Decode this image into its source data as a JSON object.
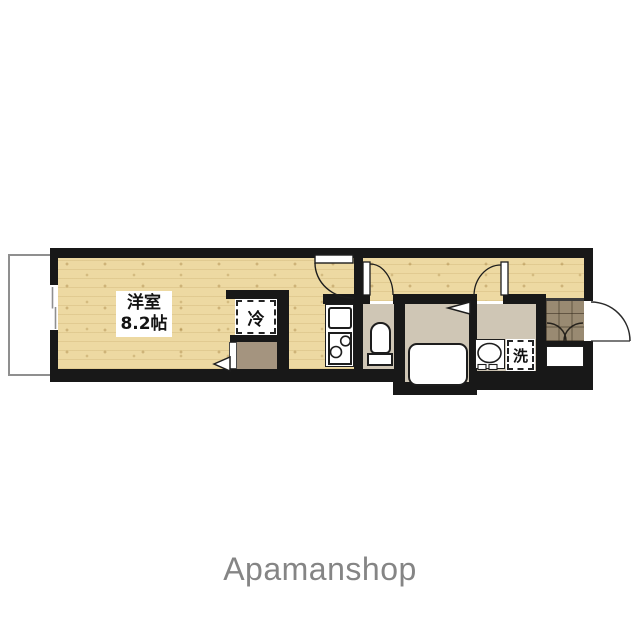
{
  "floorplan": {
    "room": {
      "name": "洋室",
      "size": "8.2帖"
    },
    "refrigerator_label": "冷",
    "laundry_label": "洗",
    "features": [
      "balcony",
      "main-room",
      "hallway",
      "kitchen",
      "toilet",
      "bathroom",
      "washroom",
      "entrance",
      "closet"
    ]
  },
  "footer": {
    "brand": "Apamanshop"
  },
  "colors": {
    "wall": "#181818",
    "wood_floor": "#edd9a2",
    "wet_area_floor": "#cfc6b5",
    "closet_floor": "#a4947f",
    "entrance_tile": "#998a72",
    "brand_text": "#858585"
  }
}
